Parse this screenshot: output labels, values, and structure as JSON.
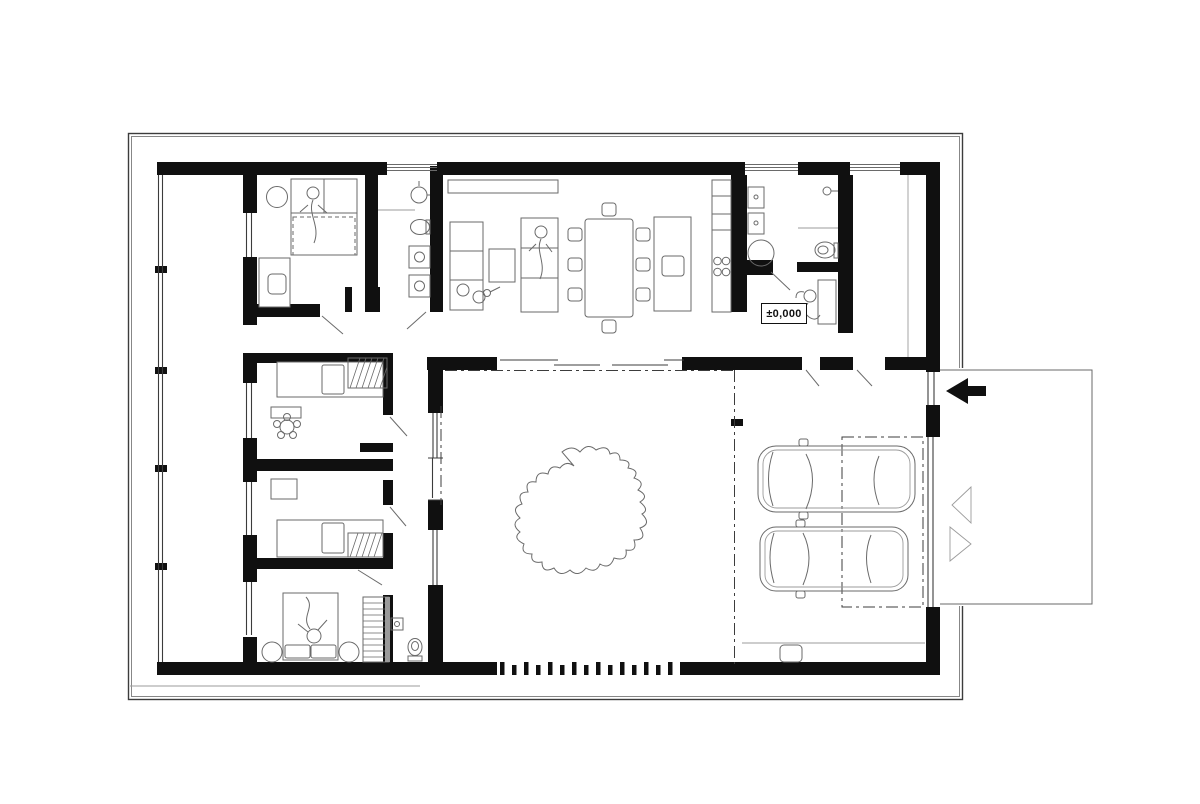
{
  "plan": {
    "level_label": "±0,000",
    "colors": {
      "wall": "#101010",
      "line_dark": "#3c3c3c",
      "line_mid": "#6a6a6a",
      "line_light": "#9b9b9b",
      "background": "#ffffff",
      "label_text": "#111111"
    },
    "markers": {
      "entry_arrow_direction": "left",
      "driveway_markers": "two outlined triangles"
    }
  }
}
